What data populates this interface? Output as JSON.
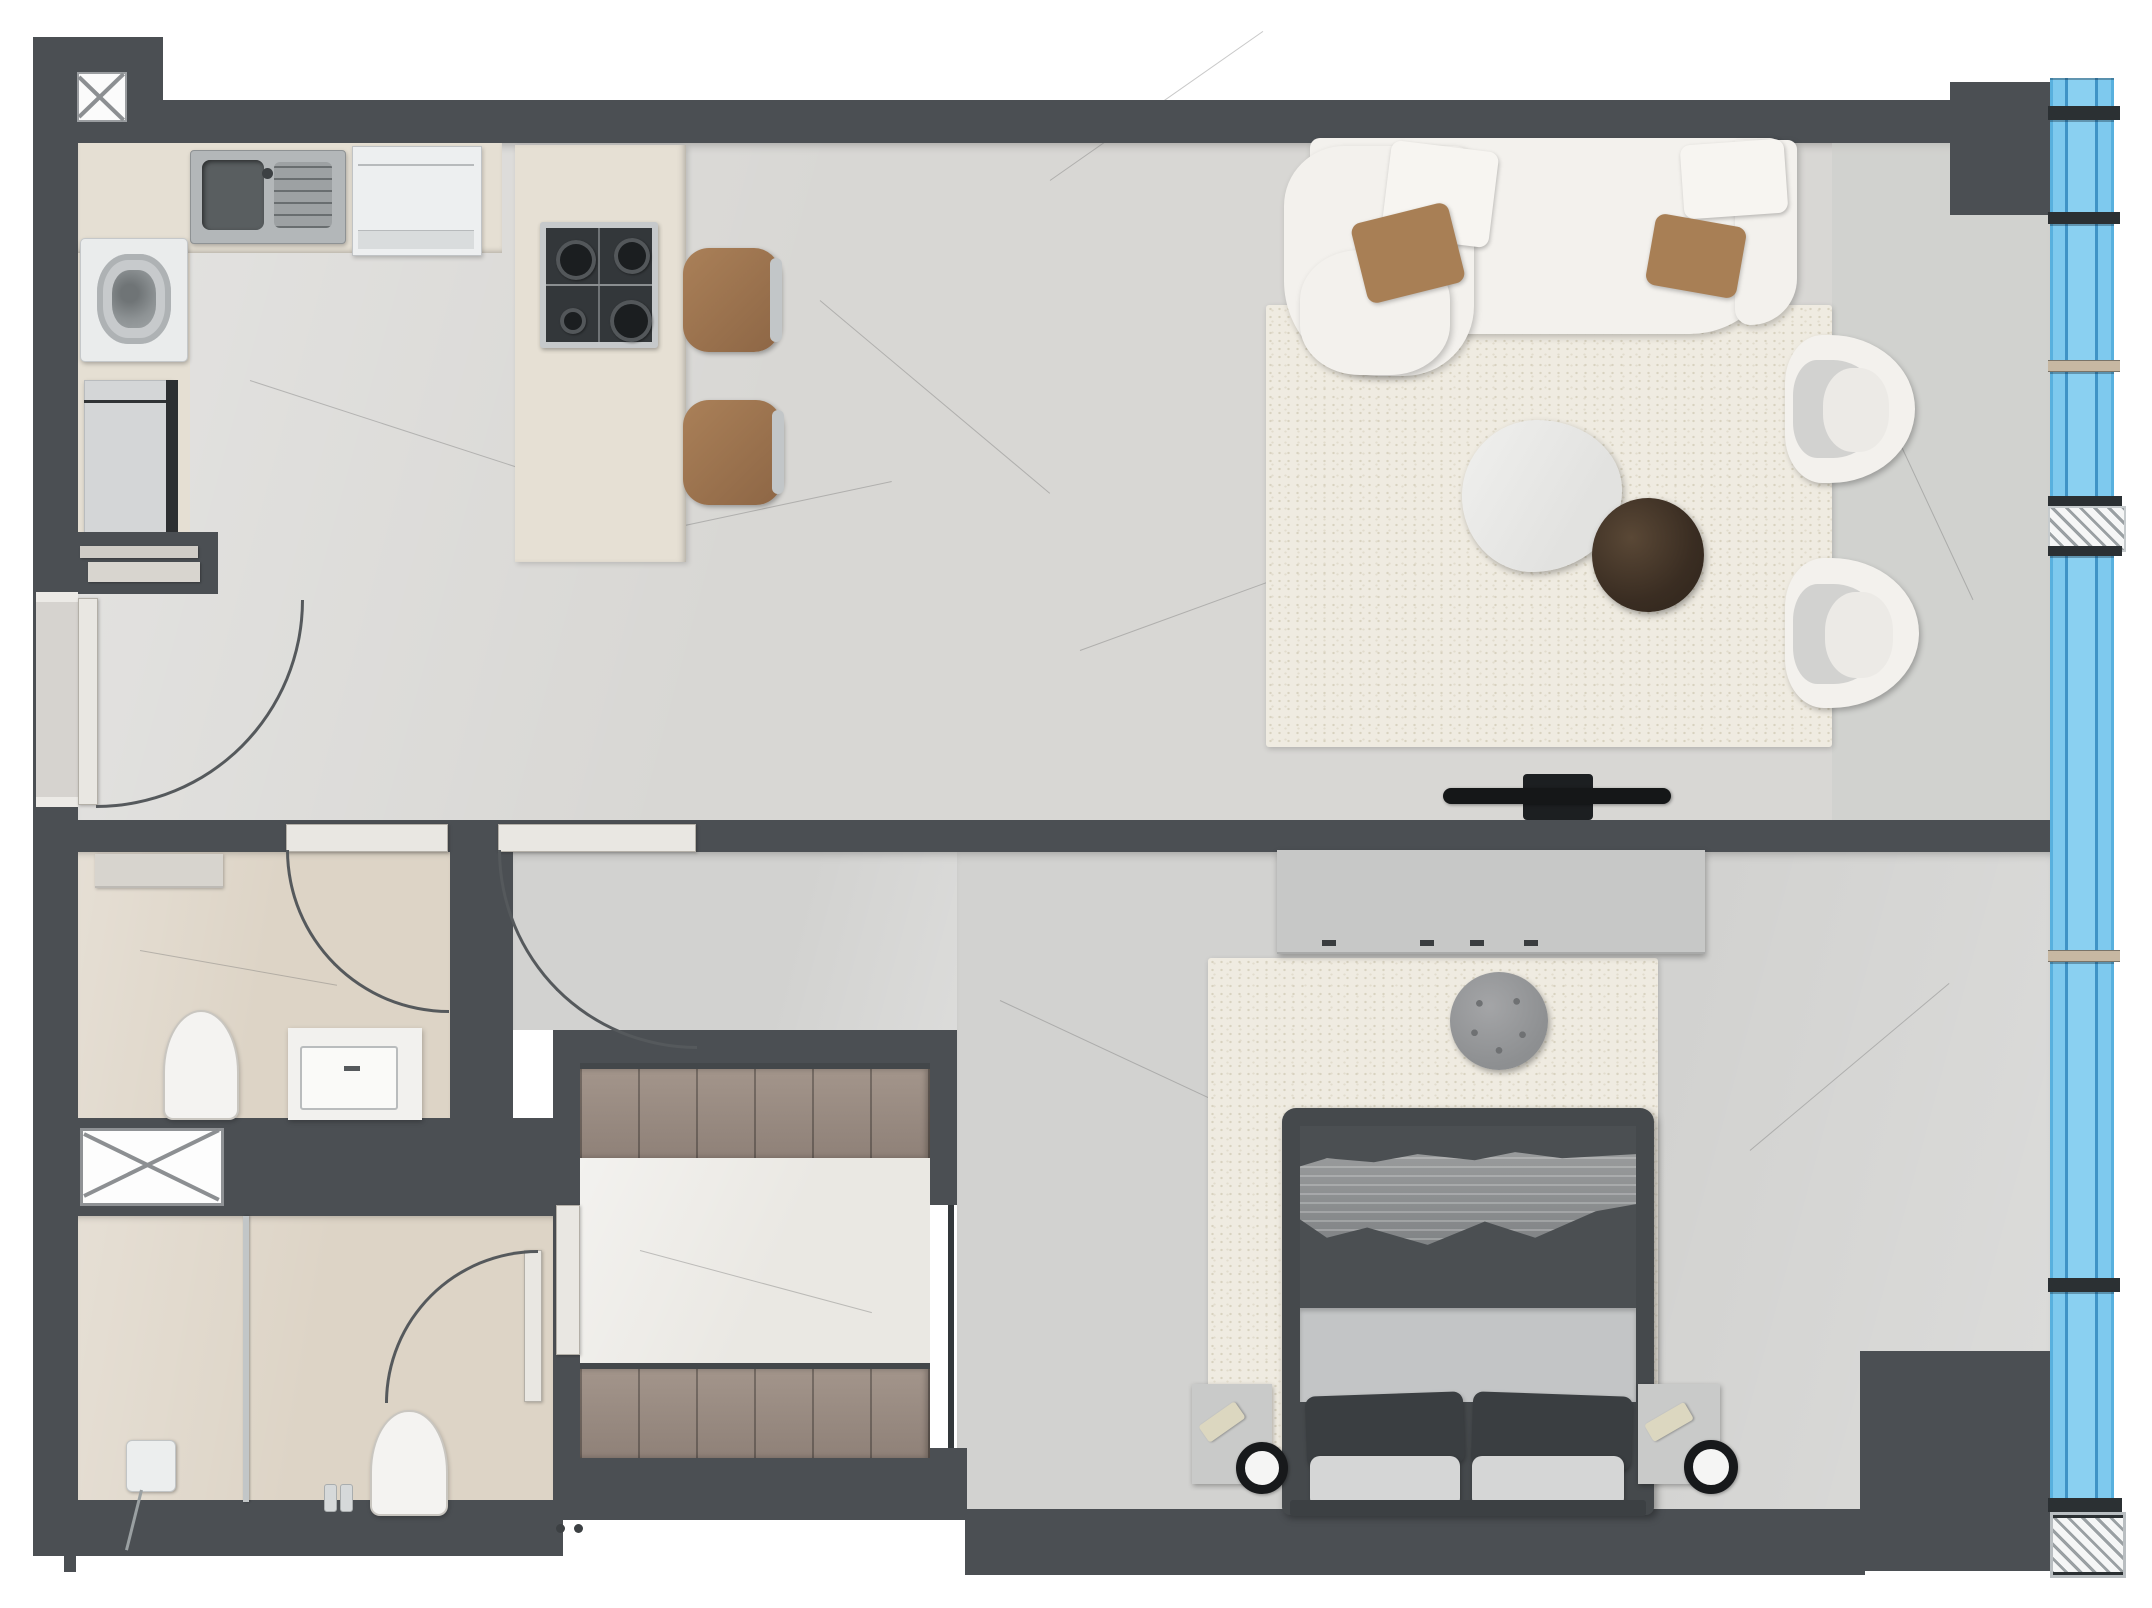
{
  "meta": {
    "type": "architectural-floor-plan",
    "style": "top-down 3d rendered apartment plan",
    "canvas": {
      "width": 2152,
      "height": 1608
    },
    "visible_text": []
  },
  "colors": {
    "wall": "#4b4f53",
    "wallDark": "#33383b",
    "arc": "#55595c",
    "floorMain": "#d8d7d4",
    "floorBed": "#d2d2d0",
    "floorEast": "#cccdca",
    "bath": "#ddd4c6",
    "wardrobeFloor": "#eae8e3",
    "counter": "#e5dfd3",
    "island": "#e6e0d4",
    "rug": "#efebe1",
    "glazing": "#7ec9ee",
    "glazingLine": "#3f93c6",
    "mullionTan": "#c7b8a2",
    "frameDark": "#2b3033",
    "sofa": "#f3f1ed",
    "brown": "#9c7350",
    "pillowBrown": "#a87f55",
    "wood": "#9a8c82",
    "bedFrame": "#45494c",
    "duvet": "#4b4f52",
    "blanket": "#8e9092",
    "sheet": "#c3c5c6",
    "pillowDark": "#3a3e41",
    "pillowLight": "#d5d6d6",
    "nightstand": "#c9cac9",
    "dresser": "#c7c8c7",
    "fixture": "#f2f1ee",
    "doorLeaf": "#e9e7e2",
    "steel": "#c2c6c8"
  },
  "legend": {
    "rooms": [
      "entry-hall",
      "kitchen",
      "open-living-room",
      "wc-bathroom",
      "shower-bathroom",
      "walk-in-wardrobe",
      "corridor",
      "bedroom",
      "glazed-facade"
    ],
    "kitchen_items": [
      "sink-double-bowl",
      "built-in-appliance",
      "washing-machine",
      "refrigerator",
      "island-counter",
      "gas-hob-4-burners",
      "bar-chair",
      "bar-chair"
    ],
    "living_items": [
      "curved-white-sofa",
      "white-cushions",
      "brown-cushions",
      "area-rug",
      "organic-marble-coffee-table",
      "dark-round-side-table",
      "white-tub-chair",
      "white-tub-chair",
      "wall-mounted-tv"
    ],
    "bedroom_items": [
      "double-bed",
      "textured-throw-blanket",
      "pillows",
      "nightstand-left",
      "nightstand-right",
      "ring-lamp",
      "remote",
      "dresser-console",
      "round-pouf",
      "area-rug"
    ],
    "bathroom_items": [
      "toilet",
      "vanity-with-basin",
      "wall-cabinet",
      "glass-shower-partition",
      "shower-control",
      "toiletry-bottles"
    ],
    "wardrobe_items": [
      "wardrobe-unit-top",
      "wardrobe-unit-bottom"
    ],
    "architecture": [
      "structural-column-x-symbol",
      "service-shaft-x-symbol",
      "door-swing-arcs",
      "glass-block-panel",
      "hatched-corner-column",
      "curtain-wall-glazing-7-panels"
    ]
  }
}
